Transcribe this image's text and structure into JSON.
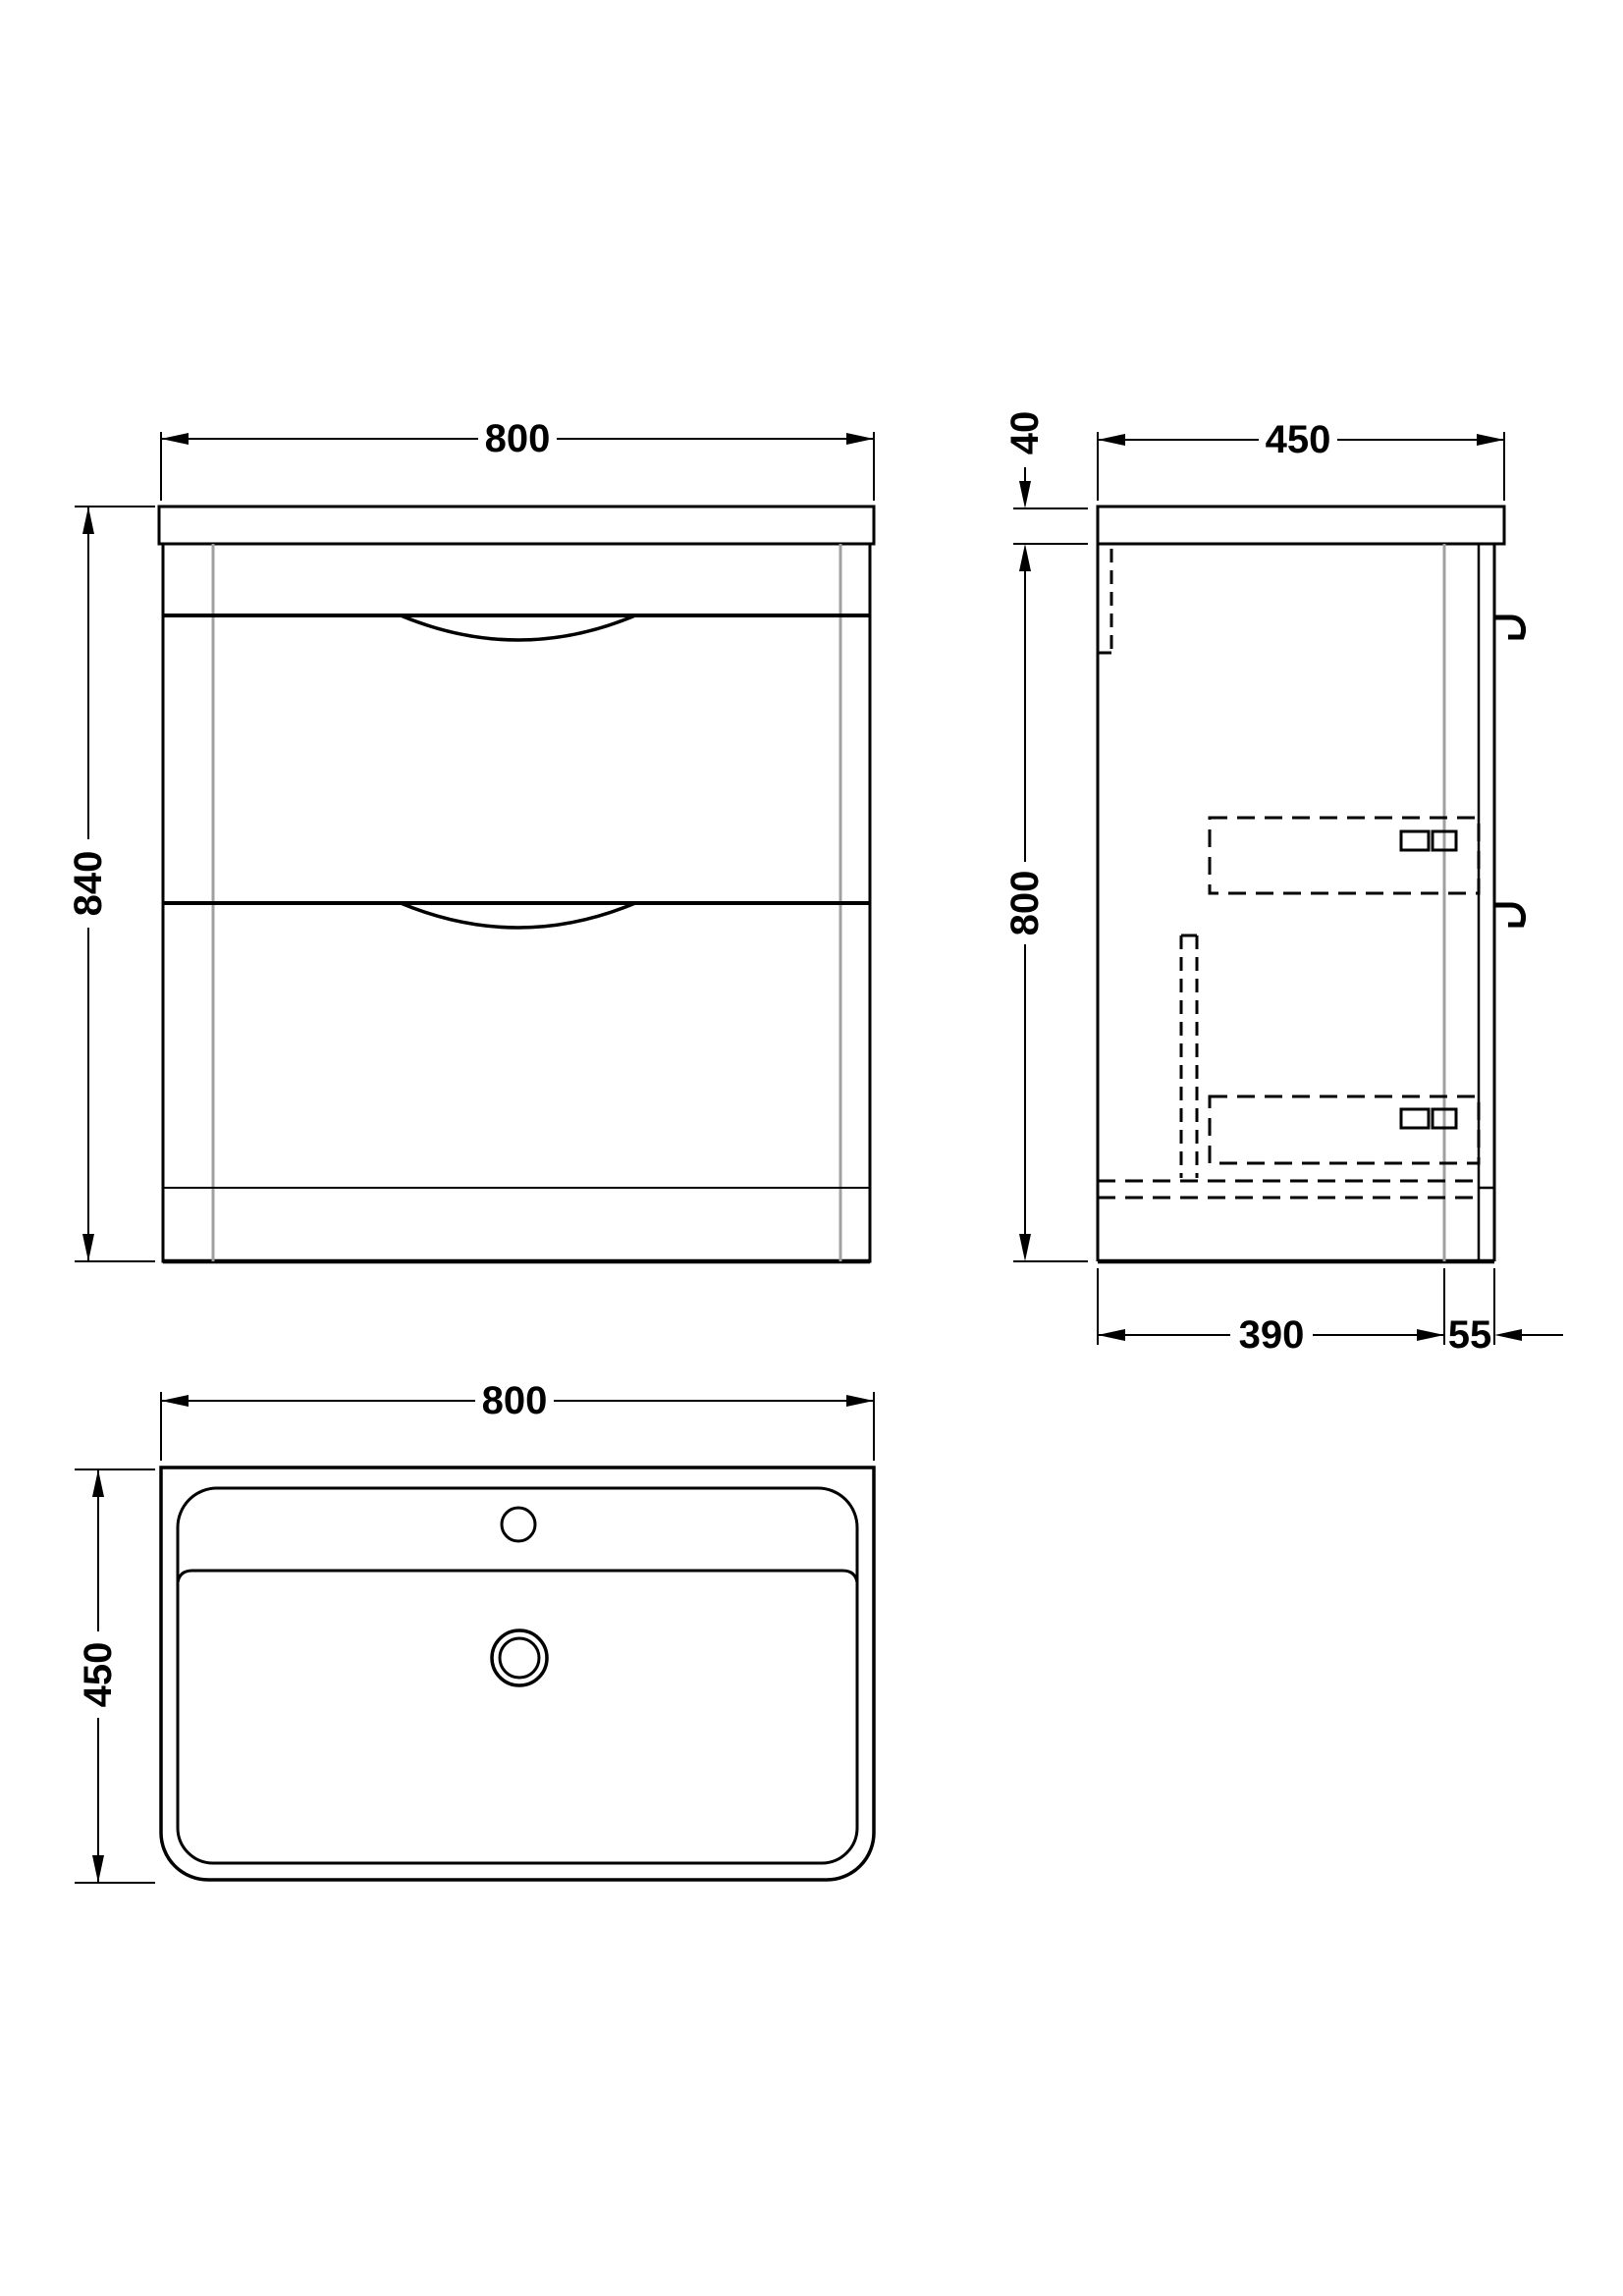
{
  "drawing": {
    "title": "Floor standing 2-drawer vanity unit with basin - dimension drawing",
    "background_color": "#ffffff",
    "line_color": "#000000",
    "hidden_edge_color": "#a0a0a0",
    "views": {
      "front_elevation": {
        "name": "front-elevation",
        "dims": {
          "width": "800",
          "height": "840"
        }
      },
      "side_elevation": {
        "name": "side-elevation",
        "dims": {
          "depth": "450",
          "worktop_thickness": "40",
          "cabinet_height": "800",
          "internal_depth": "390",
          "front_depth": "55"
        }
      },
      "basin_plan": {
        "name": "basin-plan",
        "dims": {
          "width": "800",
          "depth": "450"
        }
      }
    }
  }
}
